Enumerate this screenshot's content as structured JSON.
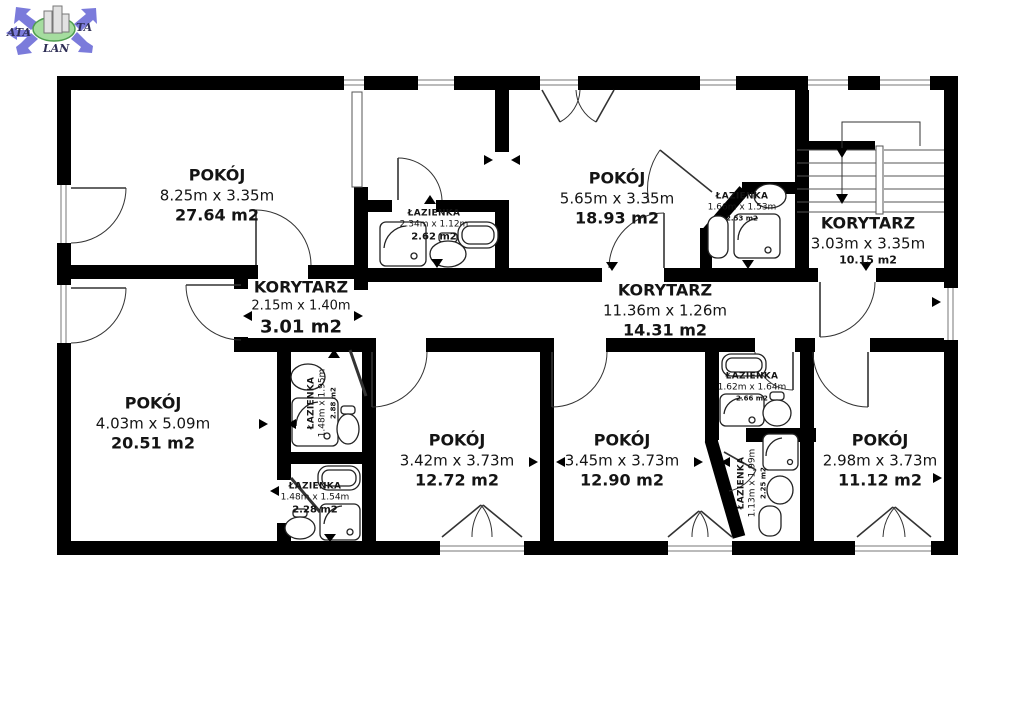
{
  "watermark": {
    "left": "ATA",
    "right": "TA",
    "bottom": "LAN"
  },
  "rooms": [
    {
      "id": "pokoj-2764",
      "name": "POKÓJ",
      "dims": "8.25m x 3.35m",
      "area": "27.64 m2"
    },
    {
      "id": "lazienka-262",
      "name": "ŁAZIENKA",
      "dims": "2.34m x 1.12m",
      "area": "2.62 m2"
    },
    {
      "id": "pokoj-1893",
      "name": "POKÓJ",
      "dims": "5.65m x 3.35m",
      "area": "18.93 m2"
    },
    {
      "id": "lazienka-253",
      "name": "ŁAZIENKA",
      "dims": "1.66m x 1.53m",
      "area": "2.53 m2"
    },
    {
      "id": "korytarz-1015",
      "name": "KORYTARZ",
      "dims": "3.03m x 3.35m",
      "area": "10.15 m2"
    },
    {
      "id": "korytarz-301",
      "name": "KORYTARZ",
      "dims": "2.15m x 1.40m",
      "area": "3.01 m2"
    },
    {
      "id": "korytarz-1431",
      "name": "KORYTARZ",
      "dims": "11.36m x 1.26m",
      "area": "14.31 m2"
    },
    {
      "id": "pokoj-2051",
      "name": "POKÓJ",
      "dims": "4.03m x 5.09m",
      "area": "20.51 m2"
    },
    {
      "id": "lazienka-288",
      "name": "ŁAZIENKA",
      "dims": "1.48m x 1.95m",
      "area": "2.88 m2"
    },
    {
      "id": "lazienka-228",
      "name": "ŁAZIENKA",
      "dims": "1.48m x 1.54m",
      "area": "2.28 m2"
    },
    {
      "id": "pokoj-1272",
      "name": "POKÓJ",
      "dims": "3.42m x 3.73m",
      "area": "12.72 m2"
    },
    {
      "id": "pokoj-1290",
      "name": "POKÓJ",
      "dims": "3.45m x 3.73m",
      "area": "12.90 m2"
    },
    {
      "id": "lazienka-266",
      "name": "ŁAZIENKA",
      "dims": "1.62m x 1.64m",
      "area": "2.66 m2"
    },
    {
      "id": "lazienka-225",
      "name": "ŁAZIENKA",
      "dims": "1.13m x 1.99m",
      "area": "2.25 m2"
    },
    {
      "id": "pokoj-1112",
      "name": "POKÓJ",
      "dims": "2.98m x 3.73m",
      "area": "11.12 m2"
    }
  ],
  "colors": {
    "wall": "#000000",
    "logo_arrow": "#7b7bdb",
    "logo_ellipse": "#a5dd9f",
    "line": "#333333"
  }
}
